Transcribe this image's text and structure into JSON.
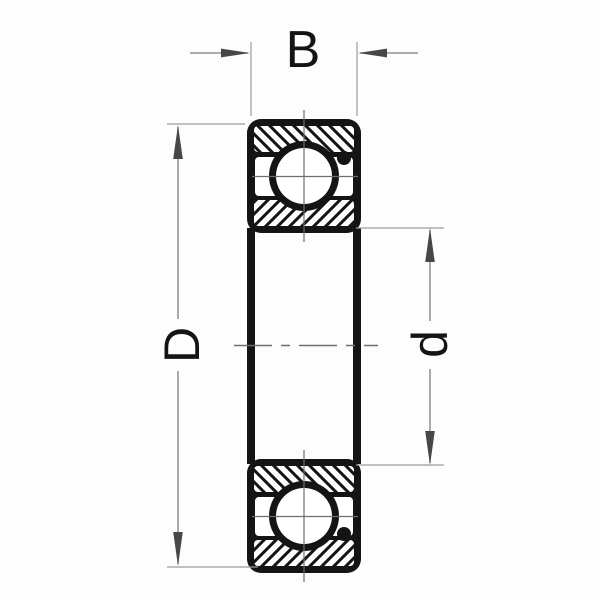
{
  "drawing": {
    "dimension_labels": {
      "width": "B",
      "outer_diameter": "D",
      "bore_diameter": "d"
    },
    "colors": {
      "ink": "#141414",
      "background": "#fdfdfd",
      "dim_line": "#7d7d7d",
      "ext_line": "#9c9c9c",
      "arrowhead": "#474747",
      "centerline": "#6e6e6e"
    }
  }
}
